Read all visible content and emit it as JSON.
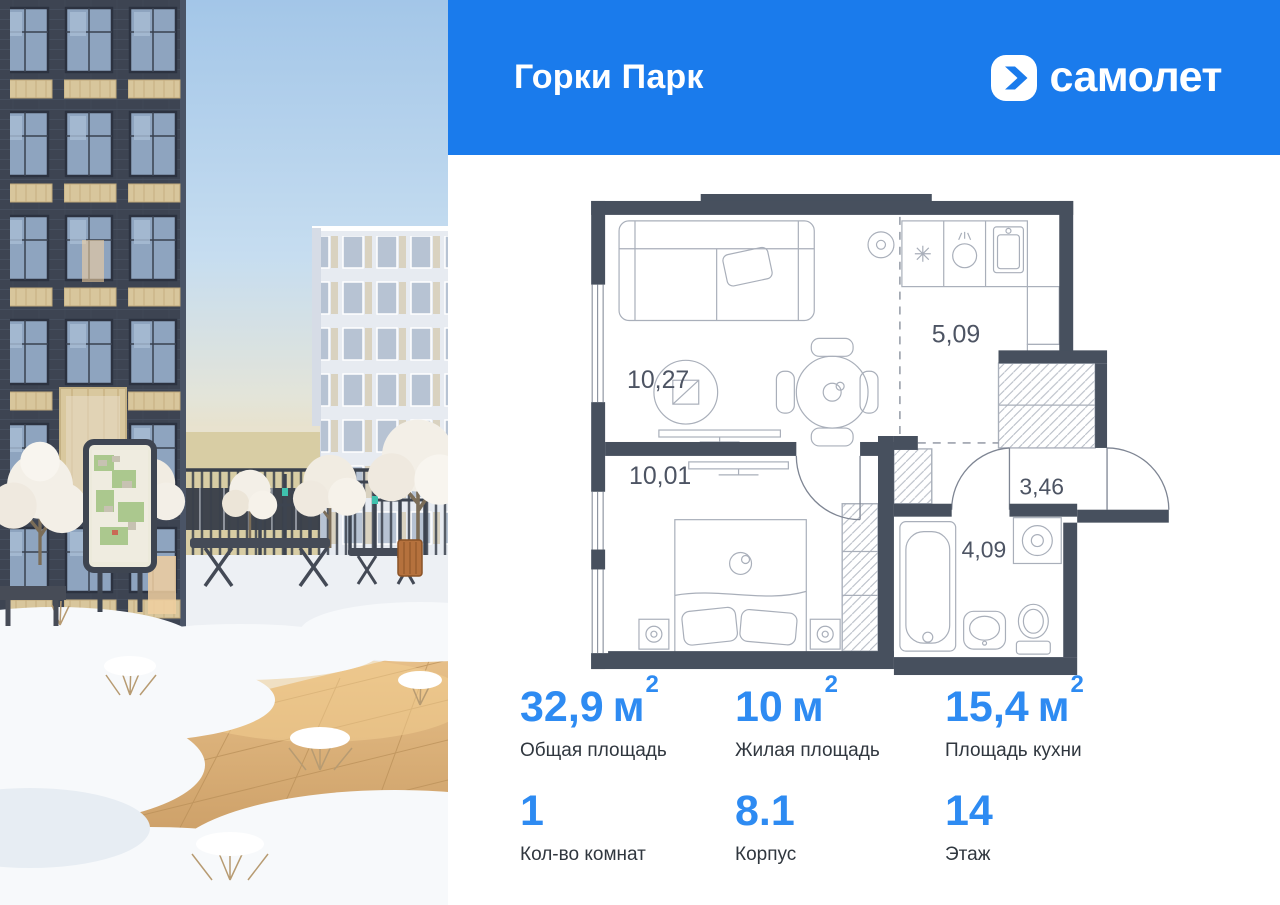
{
  "header": {
    "project_title": "Горки Парк",
    "brand_name": "самолет"
  },
  "floor_plan": {
    "rooms": {
      "living": {
        "name": "комната",
        "area": "10,27"
      },
      "kitchen": {
        "name": "кухня",
        "area": "5,09"
      },
      "bedroom": {
        "name": "спальня",
        "area": "10,01"
      },
      "hallway": {
        "name": "прихожая",
        "area": "3,46"
      },
      "bathroom": {
        "name": "санузел",
        "area": "4,09"
      }
    }
  },
  "stats": [
    {
      "value": "32,9",
      "unit": "м",
      "sup": "2",
      "label": "Общая площадь"
    },
    {
      "value": "10",
      "unit": "м",
      "sup": "2",
      "label": "Жилая площадь"
    },
    {
      "value": "15,4",
      "unit": "м",
      "sup": "2",
      "label": "Площадь кухни"
    },
    {
      "value": "1",
      "unit": "",
      "sup": "",
      "label": "Кол-во комнат"
    },
    {
      "value": "8.1",
      "unit": "",
      "sup": "",
      "label": "Корпус"
    },
    {
      "value": "14",
      "unit": "",
      "sup": "",
      "label": "Этаж"
    }
  ],
  "colors": {
    "brand_blue": "#1a7bec",
    "stat_blue": "#2e8bf2",
    "wall_slate": "#47505e",
    "plan_label": "#4d5463",
    "stat_label": "#30373f"
  }
}
